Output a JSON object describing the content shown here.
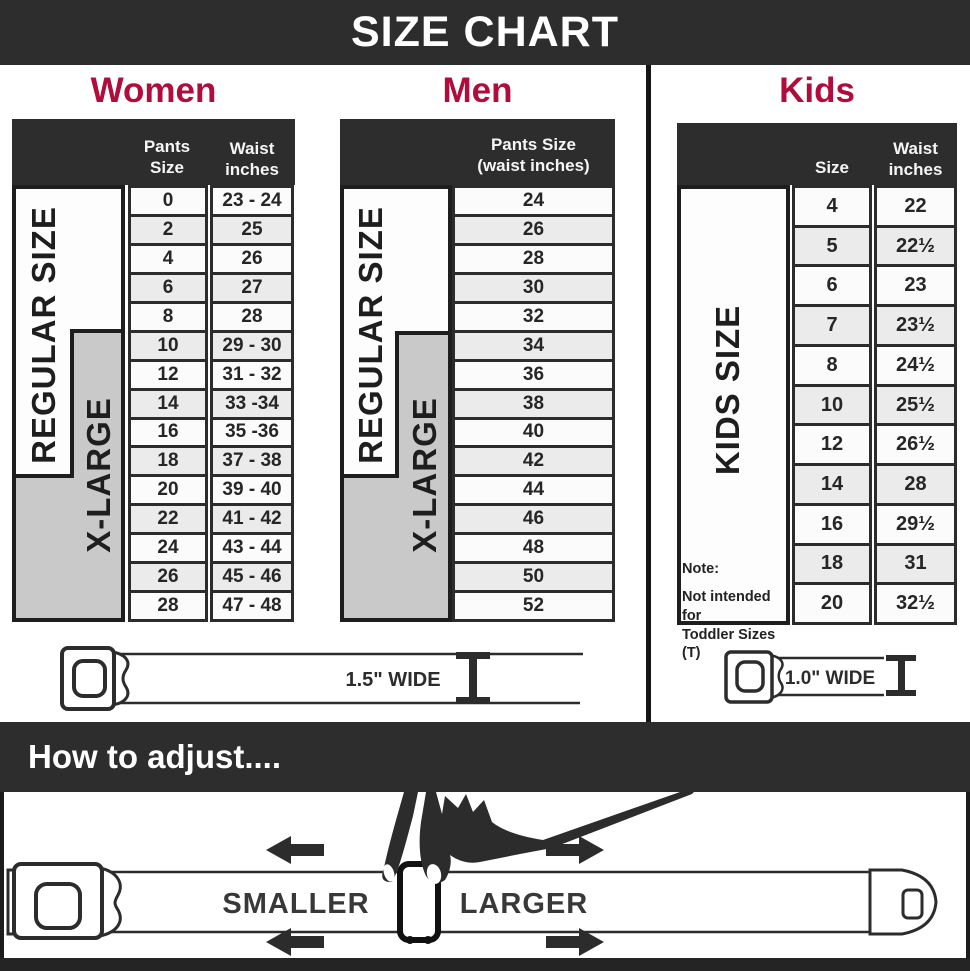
{
  "banner": {
    "title": "SIZE CHART"
  },
  "colors": {
    "dark": "#2d2d2d",
    "accent_crimson": "#b00c3c",
    "xlarge_band_gray": "#c9c9c9",
    "cell_border": "#2c2c2c"
  },
  "women": {
    "heading": "Women",
    "pants_header": "Pants Size",
    "waist_header_line1": "Waist",
    "waist_header_line2": "inches",
    "regular_label": "REGULAR SIZE",
    "xlarge_label": "X-LARGE",
    "rows": [
      [
        "0",
        "23 - 24"
      ],
      [
        "2",
        "25"
      ],
      [
        "4",
        "26"
      ],
      [
        "6",
        "27"
      ],
      [
        "8",
        "28"
      ],
      [
        "10",
        "29 - 30"
      ],
      [
        "12",
        "31 - 32"
      ],
      [
        "14",
        "33 -34"
      ],
      [
        "16",
        "35 -36"
      ],
      [
        "18",
        "37 - 38"
      ],
      [
        "20",
        "39 - 40"
      ],
      [
        "22",
        "41 - 42"
      ],
      [
        "24",
        "43 - 44"
      ],
      [
        "26",
        "45 - 46"
      ],
      [
        "28",
        "47 - 48"
      ]
    ],
    "belt_width_label": "1.5\" WIDE"
  },
  "men": {
    "heading": "Men",
    "header_line1": "Pants Size",
    "header_line2": "(waist inches)",
    "regular_label": "REGULAR SIZE",
    "xlarge_label": "X-LARGE",
    "rows": [
      "24",
      "26",
      "28",
      "30",
      "32",
      "34",
      "36",
      "38",
      "40",
      "42",
      "44",
      "46",
      "48",
      "50",
      "52"
    ]
  },
  "kids": {
    "heading": "Kids",
    "size_header": "Size",
    "waist_header_line1": "Waist",
    "waist_header_line2": "inches",
    "band_label": "KIDS SIZE",
    "note_line1": "Note:",
    "note_line2": "Not intended for",
    "note_line3": "Toddler Sizes (T)",
    "rows": [
      [
        "4",
        "22"
      ],
      [
        "5",
        "22½"
      ],
      [
        "6",
        "23"
      ],
      [
        "7",
        "23½"
      ],
      [
        "8",
        "24½"
      ],
      [
        "10",
        "25½"
      ],
      [
        "12",
        "26½"
      ],
      [
        "14",
        "28"
      ],
      [
        "16",
        "29½"
      ],
      [
        "18",
        "31"
      ],
      [
        "20",
        "32½"
      ]
    ],
    "belt_width_label": "1.0\" WIDE"
  },
  "adjust": {
    "heading": "How to adjust....",
    "smaller": "SMALLER",
    "larger": "LARGER"
  }
}
